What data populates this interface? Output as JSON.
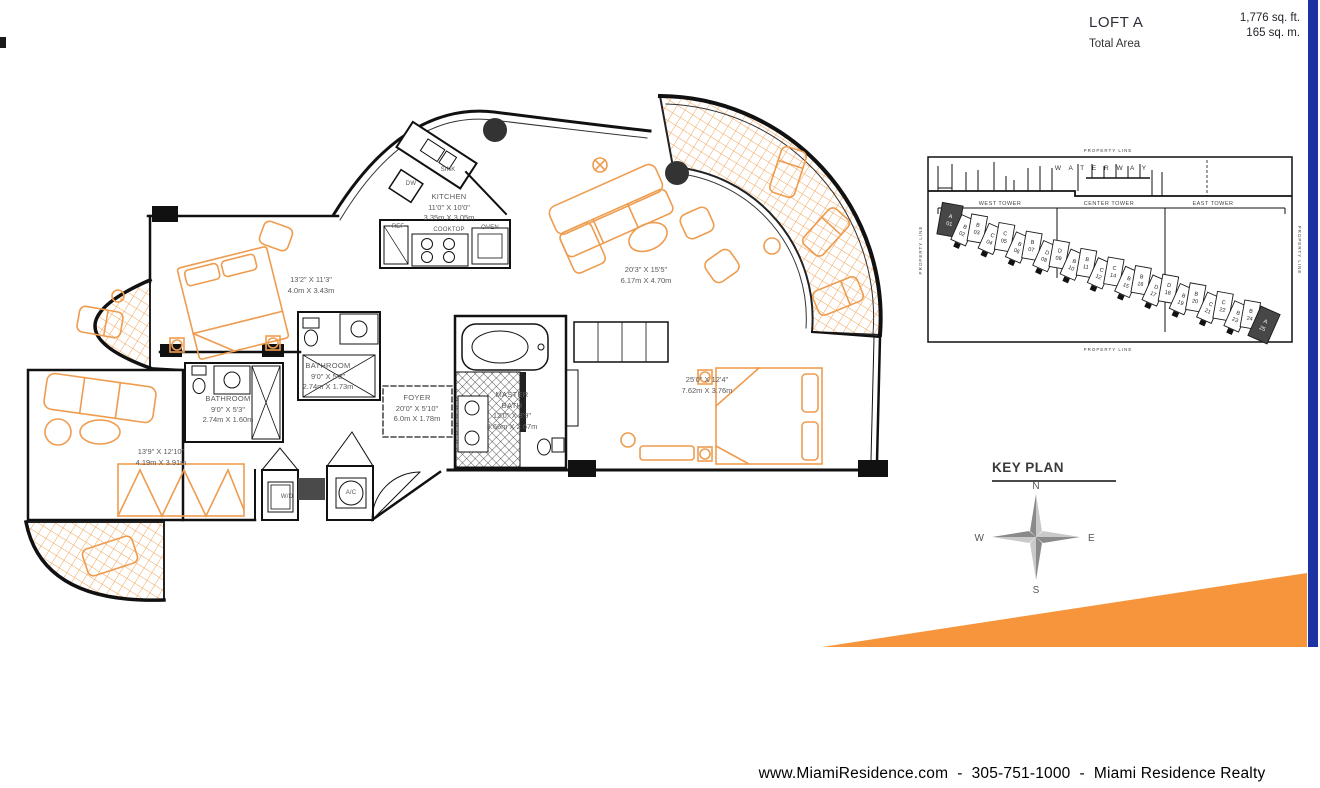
{
  "header": {
    "plan_name": "LOFT A",
    "area_label": "Total Area",
    "area_ft": "1,776 sq. ft.",
    "area_m": "165 sq. m."
  },
  "floorplan": {
    "rooms": {
      "kitchen": {
        "name": "KITCHEN",
        "dims_ft": "11'0\" X 10'0\"",
        "dims_m": "3.35m X 3.05m"
      },
      "bedroom2": {
        "dims_ft": "13'2\" X 11'3\"",
        "dims_m": "4.0m X 3.43m"
      },
      "living": {
        "dims_ft": "20'3\" X 15'5\"",
        "dims_m": "6.17m X 4.70m"
      },
      "bathroom1": {
        "name": "BATHROOM",
        "dims_ft": "9'0\" X 5'8\"",
        "dims_m": "2.74m X 1.73m"
      },
      "bathroom2": {
        "name": "BATHROOM",
        "dims_ft": "9'0\" X 5'3\"",
        "dims_m": "2.74m X 1.60m"
      },
      "foyer": {
        "name": "FOYER",
        "dims_ft": "20'0\" X 5'10\"",
        "dims_m": "6.0m X 1.78m"
      },
      "master_bath": {
        "name_line1": "MASTER",
        "name_line2": "BATH",
        "dims_ft": "12'0\" X 8'9\"",
        "dims_m": "3.66m X 2.67m"
      },
      "master_bedroom": {
        "dims_ft": "25'0\" X 12'4\"",
        "dims_m": "7.62m X 3.76m"
      },
      "bedroom3": {
        "dims_ft": "13'9\" X 12'10\"",
        "dims_m": "4.19m X 3.91m"
      }
    },
    "fixtures": {
      "sink": "SINK",
      "dw": "DW",
      "ref": "REF",
      "cooktop": "COOKTOP",
      "oven": "OVEN",
      "wd": "W/D",
      "ac": "A/C"
    }
  },
  "keyplan": {
    "title": "KEY PLAN",
    "property_line": "PROPERTY LINE",
    "waterway": "W A T E R W A Y",
    "towers": [
      "WEST TOWER",
      "CENTER TOWER",
      "EAST TOWER"
    ],
    "units": [
      {
        "letter": "A",
        "number": "01",
        "highlight": true
      },
      {
        "letter": "B",
        "number": "02"
      },
      {
        "letter": "B",
        "number": "03"
      },
      {
        "letter": "C",
        "number": "04"
      },
      {
        "letter": "C",
        "number": "05"
      },
      {
        "letter": "B",
        "number": "06"
      },
      {
        "letter": "B",
        "number": "07"
      },
      {
        "letter": "D",
        "number": "08"
      },
      {
        "letter": "D",
        "number": "09"
      },
      {
        "letter": "B",
        "number": "10"
      },
      {
        "letter": "B",
        "number": "11"
      },
      {
        "letter": "C",
        "number": "12"
      },
      {
        "letter": "C",
        "number": "14"
      },
      {
        "letter": "B",
        "number": "15"
      },
      {
        "letter": "B",
        "number": "16"
      },
      {
        "letter": "D",
        "number": "17"
      },
      {
        "letter": "D",
        "number": "18"
      },
      {
        "letter": "B",
        "number": "19"
      },
      {
        "letter": "B",
        "number": "20"
      },
      {
        "letter": "C",
        "number": "21"
      },
      {
        "letter": "C",
        "number": "22"
      },
      {
        "letter": "B",
        "number": "23"
      },
      {
        "letter": "B",
        "number": "24"
      },
      {
        "letter": "A",
        "number": "25",
        "highlight": true
      }
    ],
    "compass": {
      "n": "N",
      "e": "E",
      "s": "S",
      "w": "W"
    }
  },
  "footer": {
    "text": "www.MiamiResidence.com  -  305-751-1000  -  Miami Residence Realty"
  },
  "colors": {
    "accent_orange": "#F6953C",
    "brand_blue": "#1C33A4",
    "furniture_orange": "#EE9C4F"
  }
}
